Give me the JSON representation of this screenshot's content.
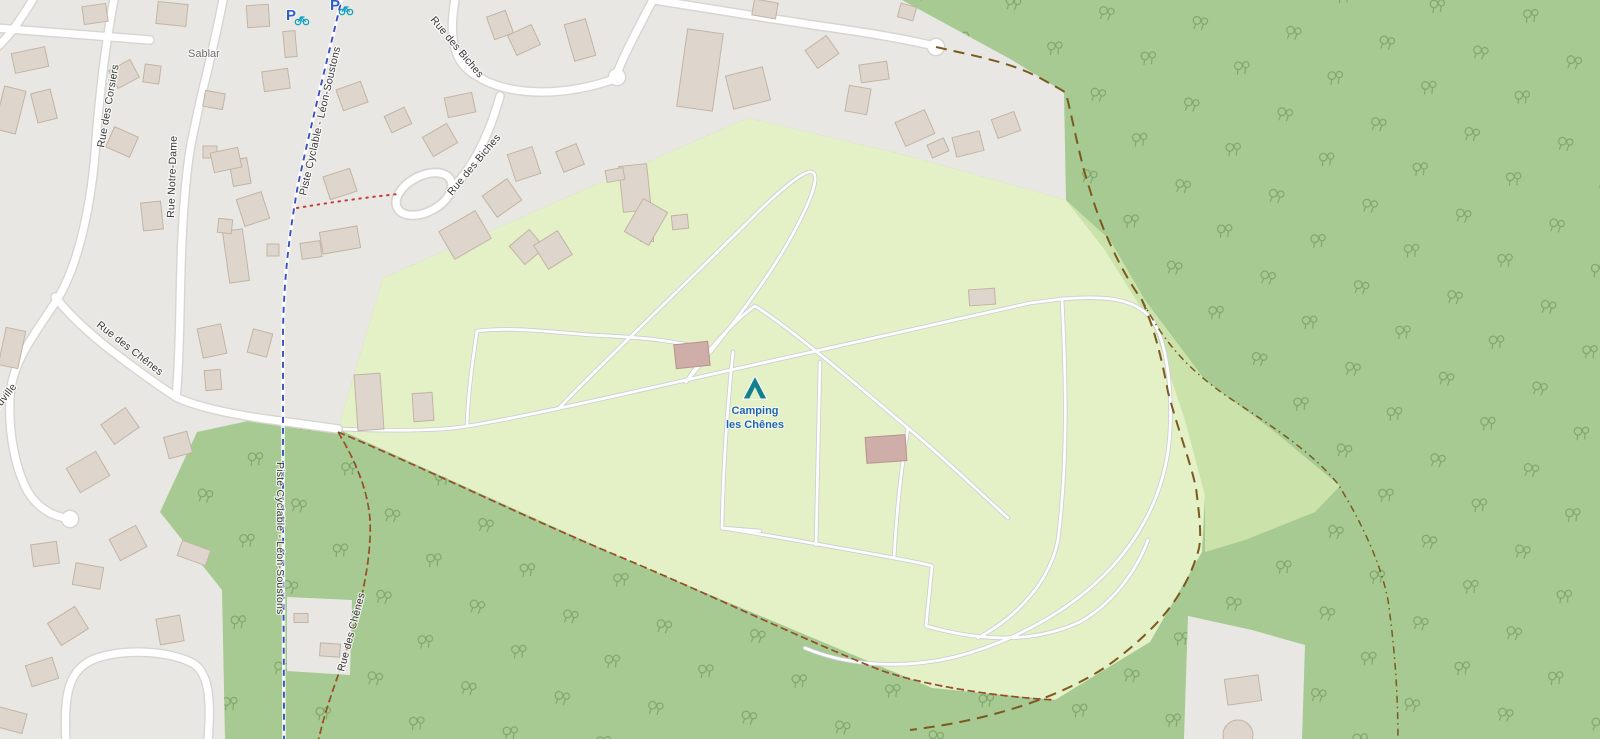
{
  "colors": {
    "urban": "#e9e7e3",
    "forest": "#a6ca92",
    "forest_tree": "#7da568",
    "camping": "#e4f0c6",
    "scrub": "#cbe3ab",
    "road_fill": "#ffffff",
    "road_casing": "#d8d5d0",
    "path_fill": "#fdfdfe",
    "path_casing": "#c8ced3",
    "building_fill": "#ded6cc",
    "building_stroke": "#c2b4a4",
    "building_pink": "#cfada8",
    "building_pink_stroke": "#b7928c",
    "boundary": "#7a5a20",
    "footpath_red": "#c43b3b",
    "cycle_blue": "#3b4fc0",
    "label_dark": "#383838",
    "label_gray": "#6f6f6f",
    "poi_blue": "#1f66b0",
    "poi_teal": "#12808f",
    "parking_blue": "#2d5fc7",
    "parking_bike": "#0a9fc0"
  },
  "labels": {
    "hamlet": "Sablar",
    "street_corsiers": "Rue des Corsiers",
    "street_notre_dame": "Rue Notre-Dame",
    "street_biches": "Rue des Biches",
    "street_chenes": "Rue des Chênes",
    "cycleway": "Piste Cyclable - Léon-Soustons",
    "street_partial": "douville",
    "campsite_line1": "Camping",
    "campsite_line2": "les Chênes",
    "parking_letter": "P"
  }
}
